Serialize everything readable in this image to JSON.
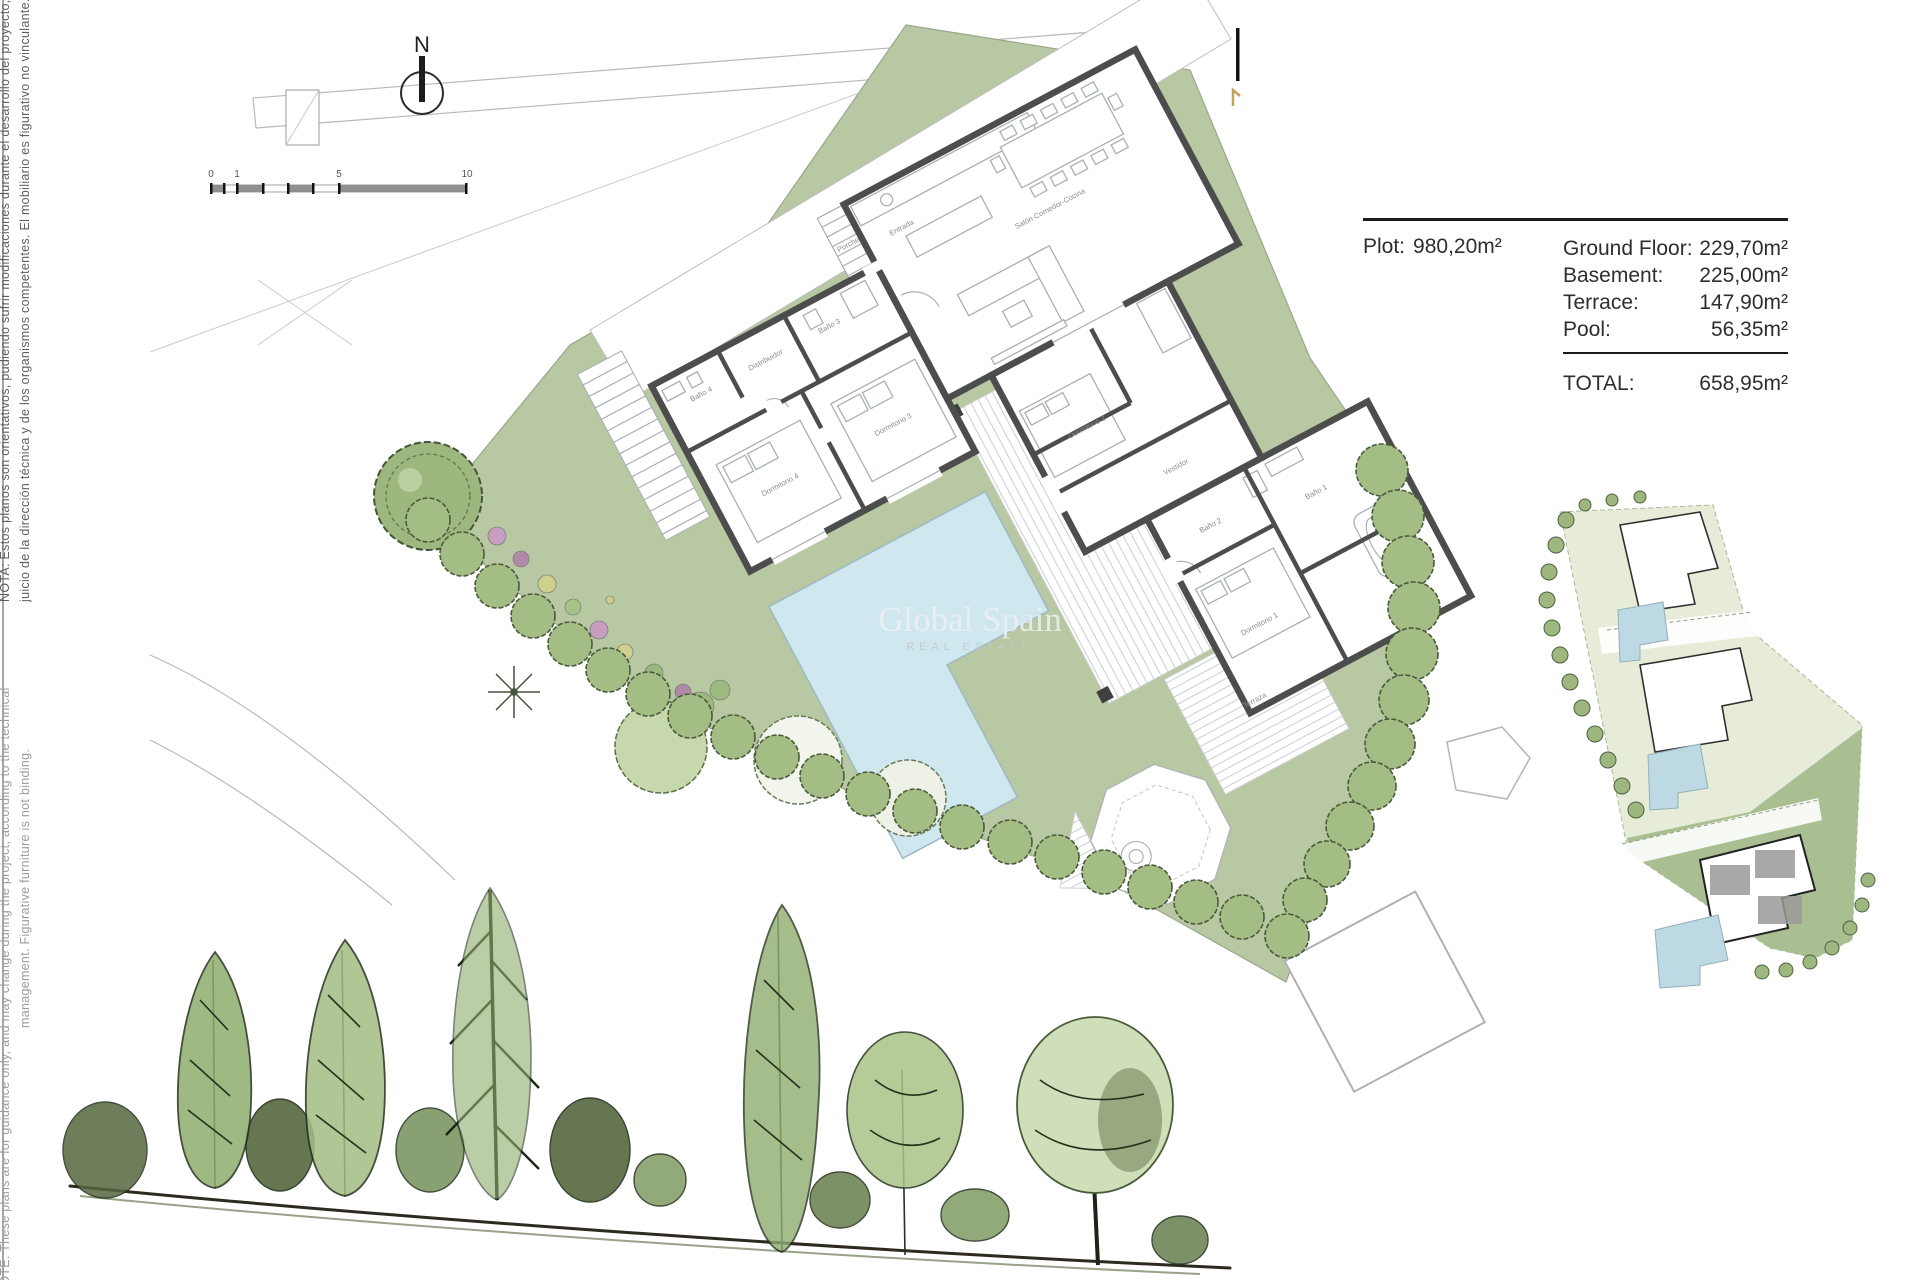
{
  "compass": {
    "label": "N"
  },
  "scale_bar": {
    "labels": [
      "0",
      "1",
      "5",
      "10"
    ]
  },
  "notes": {
    "spanish_line1": "NOTA: Estos planos son orientativos, pudiendo sufrir modificaciones durante el desarrollo del proyecto, a",
    "spanish_line2": "juicio de la dirección técnica y de los organismos competentes. El mobiliario es figurativo no vinculante.",
    "english_line1": "NOTE: These plans are for guidance only, and may change during the project, according to the technical",
    "english_line2": "management. Figurative furniture is not binding."
  },
  "area_table": {
    "plot_label": "Plot:",
    "plot_value": "980,20m²",
    "rows": [
      {
        "label": "Ground Floor:",
        "value": "229,70m²"
      },
      {
        "label": "Basement:",
        "value": "225,00m²"
      },
      {
        "label": "Terrace:",
        "value": "147,90m²"
      },
      {
        "label": "Pool:",
        "value": "56,35m²"
      }
    ],
    "total_label": "TOTAL:",
    "total_value": "658,95m²"
  },
  "watermark": {
    "line1": "Global Spain",
    "line2": "REAL ESTATE"
  },
  "plan": {
    "room_labels": [
      "Porche",
      "Entrada",
      "Distribuidor",
      "Baño 4",
      "Baño 3",
      "Dormitorio 4",
      "Dormitorio 3",
      "Salón-Comedor-Cocina",
      "Dormitorio 2",
      "Vestidor",
      "Baño 2",
      "Dormitorio 1",
      "Baño 1",
      "Terraza"
    ]
  },
  "colors": {
    "plot_green": "#b7c8a2",
    "pale_green": "#e6ecd8",
    "highlight_green": "#a9bf92",
    "pool_blue": "#cfe7ef",
    "inset_pool_blue": "#bcd9e4",
    "wall_gray": "#4d4d4d",
    "line_gray": "#b9b9b9",
    "deck_stripe": "#c9ced1",
    "tree_dark": "#44543a",
    "tree_mid": "#7f9c63",
    "tree_light": "#b9cfa0",
    "flower_pink": "#c79ec0",
    "flower_purple": "#b089a8",
    "flower_yellow": "#cfd08f",
    "accent_tan": "#c2a15f",
    "note_dark": "#5f5f5f",
    "note_light": "#9c9c9c",
    "text_dark": "#2e2e2e",
    "watermark": "#eef1f1"
  }
}
